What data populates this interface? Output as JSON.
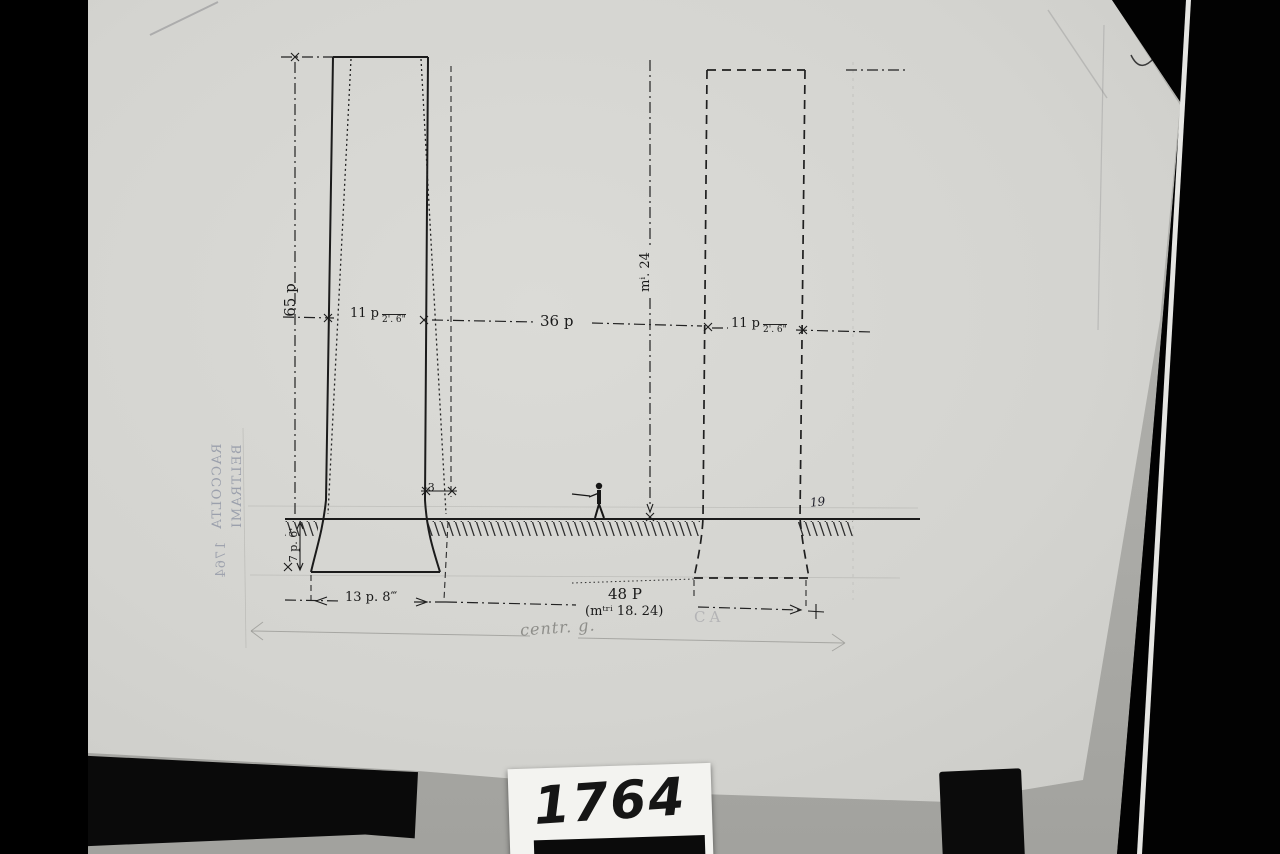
{
  "photo": {
    "catalog_card_number": "1764"
  },
  "stamp": {
    "line1": "RACCOLTA",
    "line2": "BELTRAMI",
    "year": "1764"
  },
  "drawing": {
    "dimensions": {
      "height_left": "65 p",
      "width_left_main": "11 p",
      "width_left_sub": "2'. 6\"",
      "gap_center": "36 p",
      "width_right_main": "11 p",
      "width_right_sub": "2'. 6\"",
      "height_center_metric": "mⁱ. 24",
      "offset_small": "-3",
      "depth_below_ground": "7 p. 6'",
      "base_width": "13 p. 8‴",
      "total_width": "48 P",
      "total_width_metric": "(mᵗʳⁱ 18. 24)",
      "note_right": "19"
    },
    "annotations": {
      "pencil_note": "centr. g.",
      "faint_mark": "CA"
    }
  }
}
